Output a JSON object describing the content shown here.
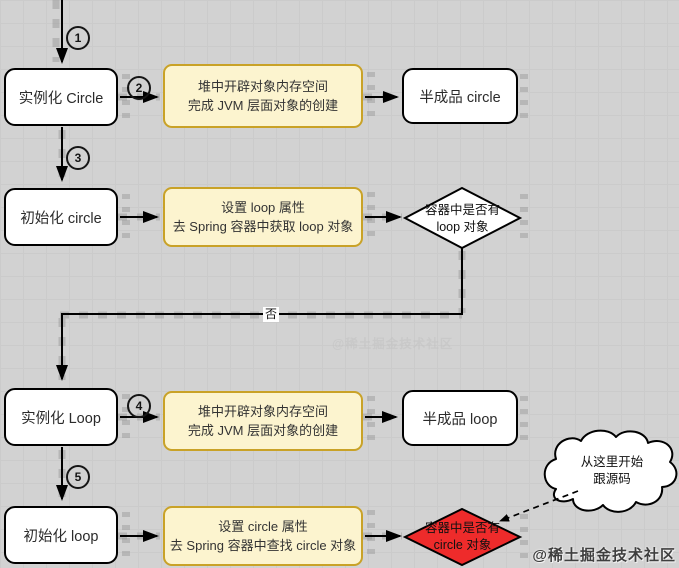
{
  "diagram": {
    "nodes": {
      "instantiate_circle": {
        "label": "实例化 Circle"
      },
      "heap_create_1": {
        "line1": "堆中开辟对象内存空间",
        "line2": "完成 JVM 层面对象的创建"
      },
      "half_product_circle": {
        "label": "半成品 circle"
      },
      "init_circle": {
        "label": "初始化 circle"
      },
      "set_loop": {
        "line1": "设置 loop 属性",
        "line2": "去 Spring 容器中获取 loop 对象"
      },
      "decision_loop": {
        "line1": "容器中是否有",
        "line2": "loop 对象"
      },
      "instantiate_loop": {
        "label": "实例化 Loop"
      },
      "heap_create_2": {
        "line1": "堆中开辟对象内存空间",
        "line2": "完成 JVM 层面对象的创建"
      },
      "half_product_loop": {
        "label": "半成品 loop"
      },
      "init_loop": {
        "label": "初始化 loop"
      },
      "set_circle": {
        "line1": "设置 circle 属性",
        "line2": "去 Spring 容器中查找 circle 对象"
      },
      "decision_circle": {
        "line1": "容器中是否有",
        "line2": "circle 对象"
      },
      "cloud_note": {
        "line1": "从这里开始",
        "line2": "跟源码"
      }
    },
    "edge_labels": {
      "no": "否"
    },
    "step_markers": [
      "1",
      "2",
      "3",
      "4",
      "5"
    ],
    "watermark": {
      "text": "@稀土掘金技术社区"
    },
    "colors": {
      "background": "#d2d2d2",
      "process_fill": "#ffffff",
      "note_fill": "#fcf4cf",
      "note_border": "#c9a227",
      "decision_fill": "#ffffff",
      "decision_alert_fill": "#ee2b2b",
      "line": "#000000"
    }
  }
}
